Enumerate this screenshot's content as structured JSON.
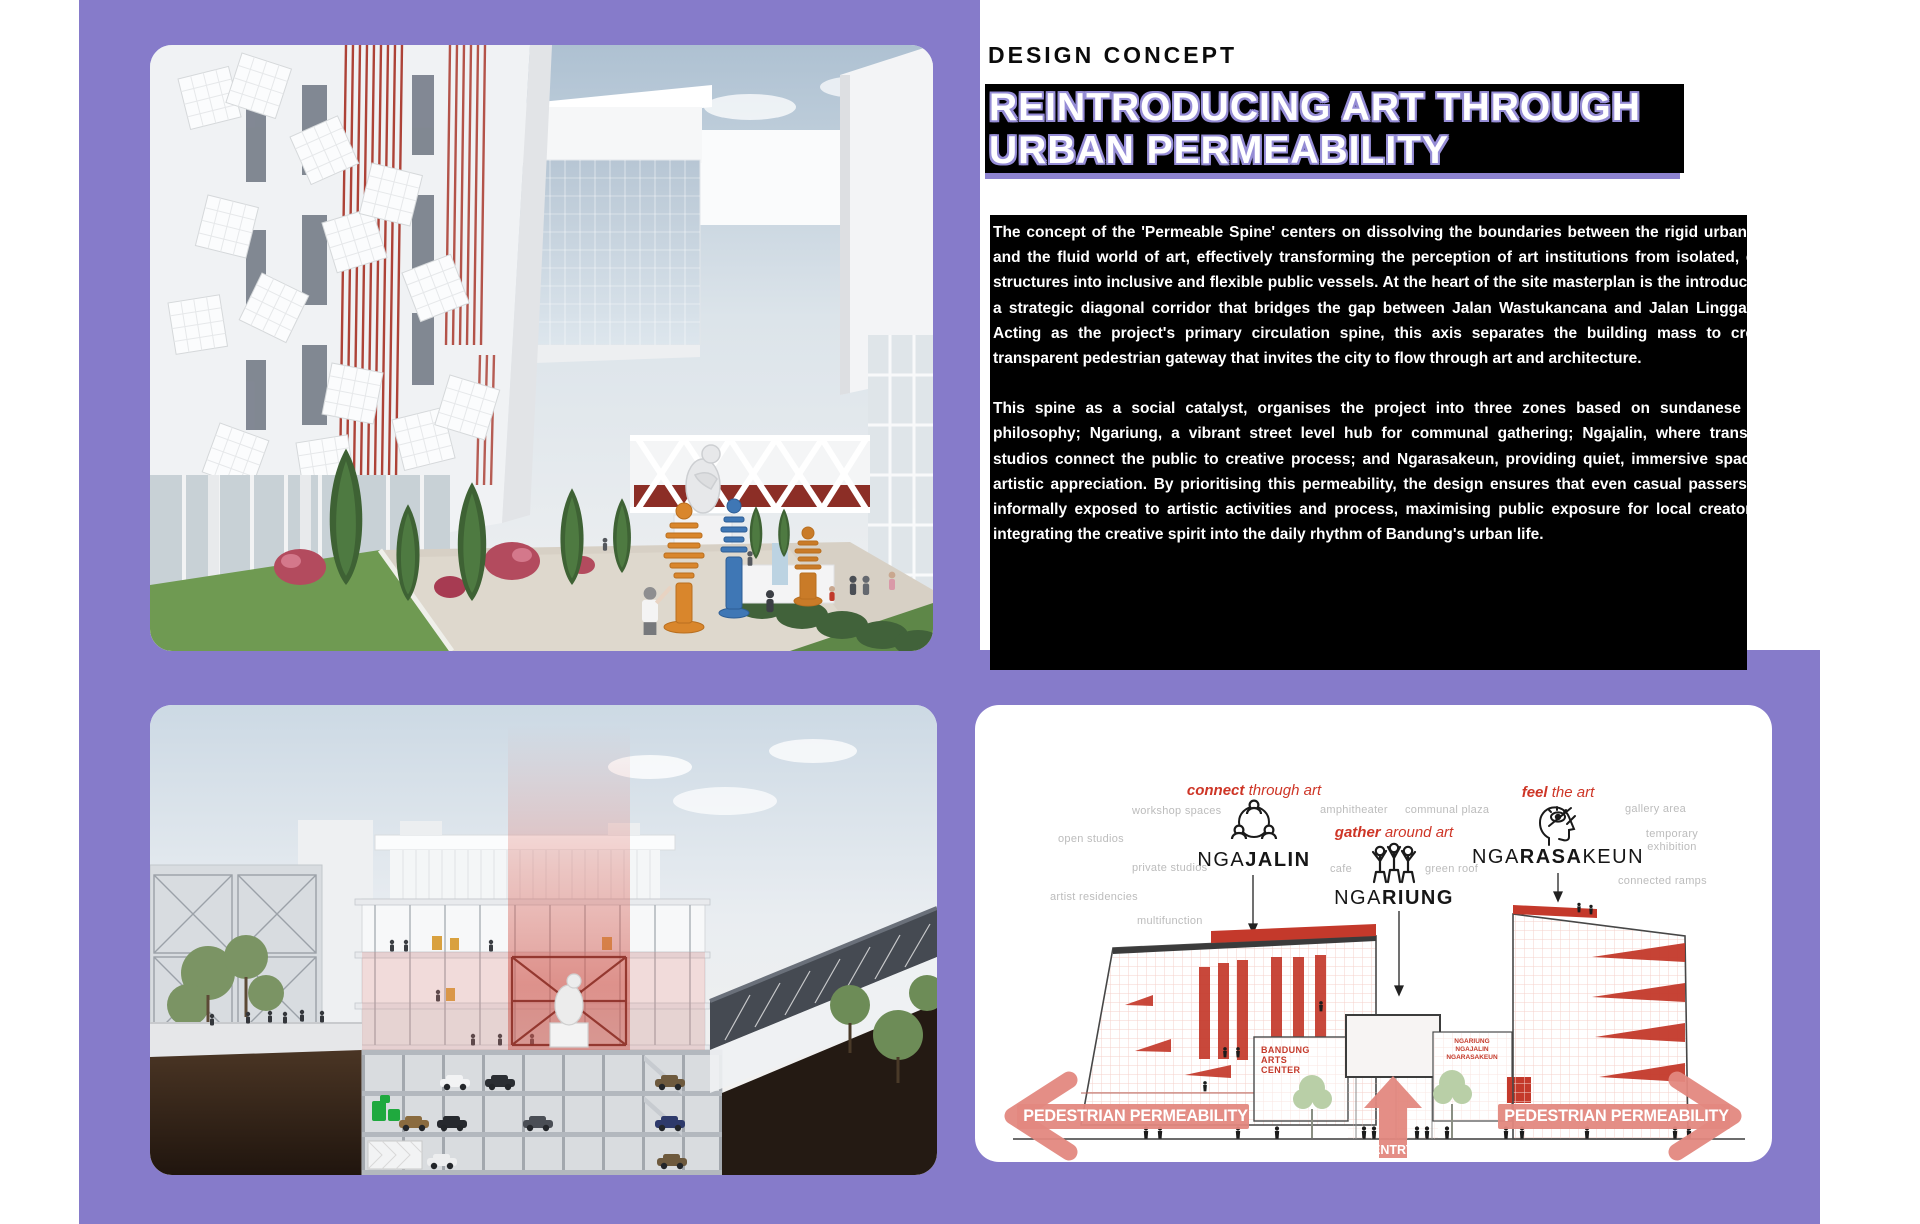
{
  "colors": {
    "purple_bg": "#867BCA",
    "title_outline_purple": "#958CD5",
    "accent_red": "#CE3526",
    "salmon_arrow": "#E3887F",
    "gray_label": "#BCBCBC"
  },
  "header": {
    "kicker": "DESIGN CONCEPT",
    "title_line1": "REINTRODUCING ART THROUGH",
    "title_line2": "URBAN PERMEABILITY"
  },
  "body": {
    "p1": "The concept of the 'Permeable Spine' centers on dissolving the boundaries between the rigid urban fabric and the fluid world of art, effectively transforming the perception of art institutions from isolated, closed structures into inclusive and flexible public vessels. At the heart of the site masterplan is the introduction of a strategic diagonal corridor that bridges the gap between Jalan Wastukancana and Jalan Linggawastu. Acting as the project's primary circulation spine, this axis separates the building mass to create a transparent pedestrian gateway that invites the city to flow through art and architecture.",
    "p2": "This spine as a social catalyst, organises the project into three zones based on sundanese social philosophy; Ngariung, a vibrant street level hub for communal gathering; Ngajalin, where transparent studios connect the public to creative process; and Ngarasakeun, providing quiet, immersive spaces for artistic appreciation. By prioritising this permeability, the design ensures that even casual passersby are informally exposed to artistic activities and process, maximising public exposure for local creators and integrating the creative spirit into the daily rhythm of Bandung's urban life."
  },
  "diagram": {
    "groups": [
      {
        "tag_bold": "connect",
        "tag_rest": " through art",
        "icon": "people-network-icon",
        "name_pre": "NGA",
        "name_bold": "JALIN",
        "name_post": "",
        "labels": [
          "workshop spaces",
          "open studios",
          "private studios",
          "artist residencies",
          "multifunction"
        ]
      },
      {
        "tag_bold": "gather",
        "tag_rest": " around art",
        "icon": "people-group-icon",
        "name_pre": "NGA",
        "name_bold": "RIUNG",
        "name_post": "",
        "labels": [
          "amphitheater",
          "communal plaza",
          "cafe",
          "green roof"
        ]
      },
      {
        "tag_bold": "feel",
        "tag_rest": " the art",
        "icon": "head-eye-icon",
        "name_pre": "NGA",
        "name_bold": "RASA",
        "name_post": "KEUN",
        "labels": [
          "gallery area",
          "temporary exhibition",
          "connected ramps"
        ]
      }
    ],
    "left_arrow_label": "PEDESTRIAN PERMEABILITY",
    "right_arrow_label": "PEDESTRIAN PERMEABILITY",
    "entry_label": "ENTRY",
    "building_left_label": "BANDUNG\nARTS\nCENTER",
    "building_right_label": "NGARIUNG\nNGAJALIN\nNGARASAKEUN"
  }
}
